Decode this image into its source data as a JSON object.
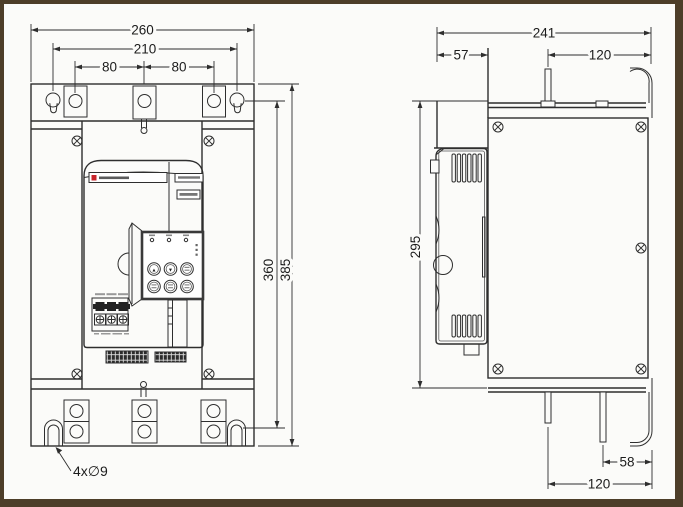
{
  "drawing": {
    "type": "dimensional-outline-drawing",
    "views": [
      "front view",
      "side view"
    ],
    "colors": {
      "line": "#2e2e2e",
      "background": "#fbfbf9",
      "frame_border": "#4d3e29",
      "brand_accent_red": "#c8252b"
    }
  },
  "front_view": {
    "dimensions": {
      "overall_width": "260",
      "mounting_width": "210",
      "hole_pitch_left": "80",
      "hole_pitch_right": "80",
      "mounting_height": "360",
      "overall_height": "385",
      "mounting_hole_note": "4x∅9"
    },
    "keypad": {
      "up": "▲",
      "down": "▼"
    }
  },
  "side_view": {
    "dimensions": {
      "overall_depth": "241",
      "front_section_depth": "57",
      "top_busbar_offset": "120",
      "panel_height": "295",
      "bottom_busbar_spacing": "58",
      "bottom_busbar_offset": "120"
    }
  }
}
